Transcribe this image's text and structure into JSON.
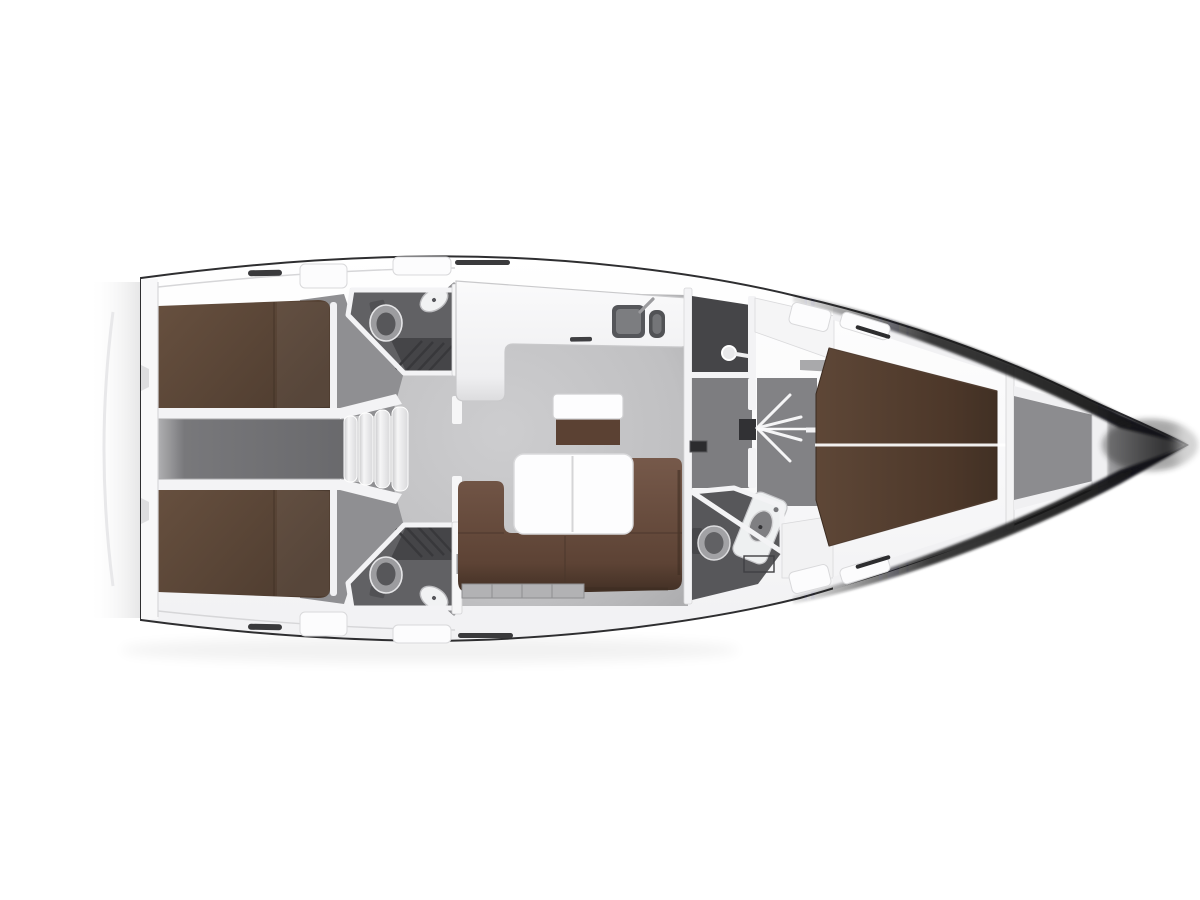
{
  "meta": {
    "title": "Sailing yacht interior layout plan, top view",
    "orientation": "bow to the right, stern to the left",
    "style": "3D rendered floor plan on white background"
  },
  "palette": {
    "pageBg": "#ffffff",
    "deck": "#f8f8f9",
    "wall": "#f3f3f5",
    "outline": "#2e2e30",
    "salonFloor": "#c4c4c6",
    "cabinFloor": "#8f8f92",
    "corridorFloor": "#6e6e71",
    "headFloor": "#616164",
    "showerFloor": "#454548",
    "lobbyFloor": "#7d7d80",
    "lockerFloor": "#8c8c8f",
    "berthBrown": "#5f4a3d",
    "fwdBerthBrown": "#58422f",
    "sofaBrown": "#6e5547",
    "cabinetBrown": "#5b4133",
    "tableWhite": "#fdfdfe",
    "sinkDark": "#55565a",
    "fixtureLight": "#ececee",
    "bowDark": "#1c1c1e",
    "seamBrownDark": "#3f2e23",
    "lockerStrip": "#b2b2b4"
  },
  "regions": [
    {
      "id": "swim-platform",
      "label": "stern transom and swim platform edge"
    },
    {
      "id": "aft-cabin-top",
      "label": "aft double cabin, top side"
    },
    {
      "id": "aft-cabin-bottom",
      "label": "aft double cabin, bottom side"
    },
    {
      "id": "engine-corridor",
      "label": "engine space between aft cabins"
    },
    {
      "id": "companionway-steps",
      "label": "companionway steps to cockpit"
    },
    {
      "id": "aft-head-top",
      "label": "aft bathroom with shower grating, top side"
    },
    {
      "id": "aft-head-bottom",
      "label": "aft bathroom with shower grating, bottom side"
    },
    {
      "id": "galley",
      "label": "L-shaped galley with double sink"
    },
    {
      "id": "salon",
      "label": "salon with L-shaped sofa and white table"
    },
    {
      "id": "forward-shower",
      "label": "separate shower compartment forward"
    },
    {
      "id": "forward-head",
      "label": "forward bathroom with toilet and vanity"
    },
    {
      "id": "forward-cabin",
      "label": "forward cabin with island double berth"
    },
    {
      "id": "anchor-locker",
      "label": "bow anchor locker"
    },
    {
      "id": "bow-tip",
      "label": "shaded bow hull converging to a point"
    }
  ],
  "fixtures": [
    {
      "id": "galley-sink-double",
      "label": "double galley sink with faucet"
    },
    {
      "id": "toilet",
      "label": "marine toilet (x3)"
    },
    {
      "id": "wash-basin",
      "label": "oval wash basin (x3)"
    },
    {
      "id": "shower-head",
      "label": "shower head on flexible hose"
    },
    {
      "id": "salon-table",
      "label": "two-leaf folding salon table"
    },
    {
      "id": "mast-cabinet",
      "label": "mast post cabinet with white top"
    },
    {
      "id": "deck-hatch",
      "label": "white deck hatches along side decks"
    }
  ]
}
